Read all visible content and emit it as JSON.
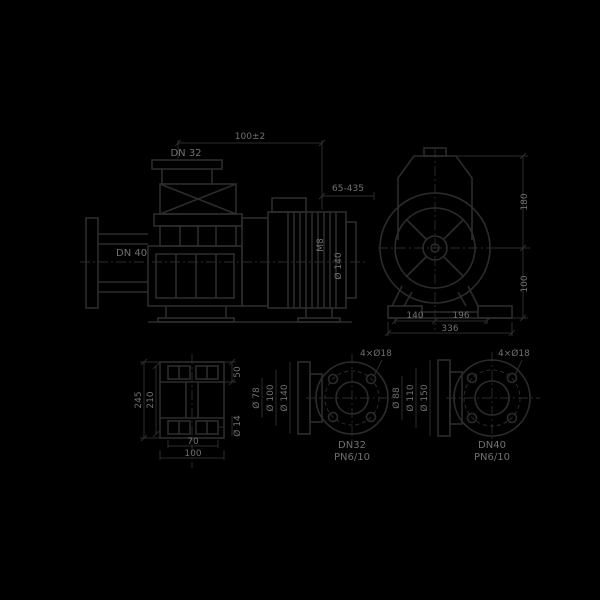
{
  "colors": {
    "background": "#000000",
    "line": "#2c2c2c",
    "text": "#707070"
  },
  "views": {
    "side": {
      "flange_top": "DN 32",
      "flange_suction": "DN 40",
      "length_tolerance": "100±2",
      "motor_range": "65-435",
      "coupling_label": "M8",
      "motor_flange_dia": "Ø 140"
    },
    "front": {
      "height_upper": "180",
      "height_lower": "100",
      "foot_spacing_left": "140",
      "foot_spacing_right": "196",
      "base_width": "336"
    },
    "foot_plan": {
      "width_inner": "210",
      "width_outer": "245",
      "rail_height": "50",
      "hole_dia": "Ø 14",
      "length_inner": "70",
      "length_outer": "100"
    },
    "flange_a": {
      "bolt_holes": "4×Ø18",
      "dia_inner": "Ø 78",
      "dia_bolt_circle": "Ø 100",
      "dia_outer": "Ø 140",
      "size": "DN32",
      "pressure": "PN6/10"
    },
    "flange_b": {
      "bolt_holes": "4×Ø18",
      "dia_inner": "Ø 88",
      "dia_bolt_circle": "Ø 110",
      "dia_outer": "Ø 150",
      "size": "DN40",
      "pressure": "PN6/10"
    }
  }
}
